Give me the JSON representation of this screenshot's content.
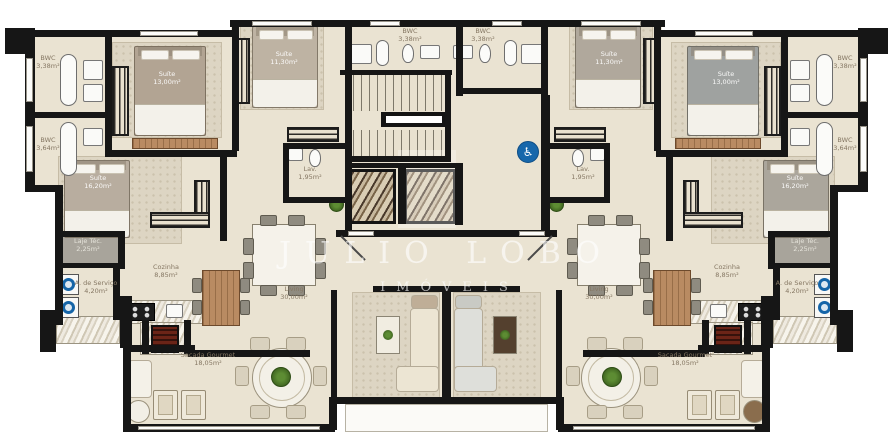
{
  "watermark": {
    "line1": "JULIO LOBO",
    "line2": "IMÓVEIS"
  },
  "rooms": {
    "bwc_338": {
      "name": "BWC",
      "area": "3,38m²"
    },
    "bwc_364": {
      "name": "BWC",
      "area": "3,64m²"
    },
    "suite_13": {
      "name": "Suíte",
      "area": "13,00m²"
    },
    "suite_11": {
      "name": "Suíte",
      "area": "11,30m²"
    },
    "suite_16": {
      "name": "Suíte",
      "area": "16,20m²"
    },
    "lav": {
      "name": "Lav.",
      "area": "1,95m²"
    },
    "laje_tec": {
      "name": "Laje Téc.",
      "area": "2,25m²"
    },
    "area_servico": {
      "name": "A. de Serviço",
      "area": "4,20m²"
    },
    "cozinha": {
      "name": "Cozinha",
      "area": "8,85m²"
    },
    "living": {
      "name": "Living",
      "area": "30,00m²"
    },
    "sacada_gourmet": {
      "name": "Sacada Gourmet",
      "area": "18,05m²"
    }
  },
  "icons": {
    "accessibility": "♿"
  },
  "colors": {
    "wall": "#161616",
    "floor": "#eae3d2",
    "laje_floor": "#a8a49b",
    "accessibility_blue": "#1767ab",
    "grill_red": "#6b2417"
  }
}
